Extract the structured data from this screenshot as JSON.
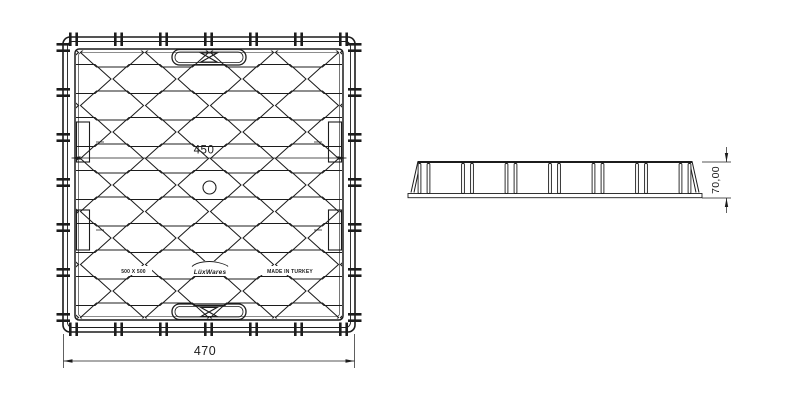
{
  "plan_view": {
    "inner_dim": "450",
    "width_dim": "470",
    "markings": {
      "size": "500 X 500",
      "brand": "LüxWares",
      "origin": "MADE IN TURKEY"
    }
  },
  "side_view": {
    "height_dim": "70,00"
  },
  "colors": {
    "line": "#1c1c1c",
    "background": "#ffffff"
  }
}
